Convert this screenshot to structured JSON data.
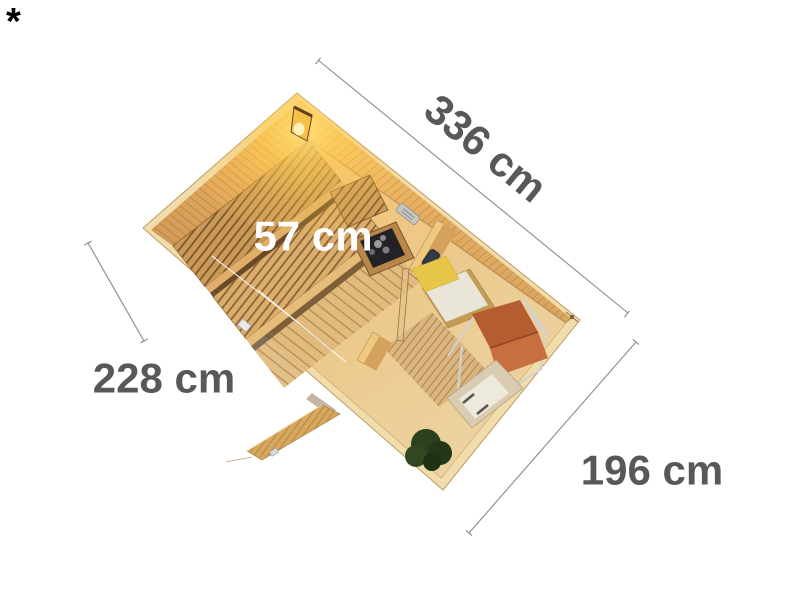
{
  "page": {
    "background": "#ffffff",
    "footnote_marker": "*"
  },
  "dimensions": {
    "top_right": {
      "label": "336 cm"
    },
    "bench": {
      "label": "57 cm"
    },
    "left": {
      "label": "228 cm"
    },
    "bottom_right": {
      "label": "196 cm"
    }
  },
  "colors": {
    "dimension_text": "#58585a",
    "dimension_line": "#8c8c8c",
    "bench_label_text": "#ffffff",
    "footnote_text": "#000000",
    "wood_top_edge": "#f0ddab",
    "wood_wall_warm": "#f7bd55",
    "wood_wall": "#d9a660",
    "wood_floor": "#ebd2a0",
    "lamp_glow": "#ffce54",
    "heater_body": "#232327",
    "deckchair_canvas": "#b65c31",
    "deckchair_seat": "#c86f40",
    "bed_pillow": "#e8c64a",
    "bed_mattress": "#e9e5d8",
    "lounger_shell": "#d9ccb2",
    "plant_foliage": "#2c401d",
    "glass_door": "#e1c38c"
  }
}
